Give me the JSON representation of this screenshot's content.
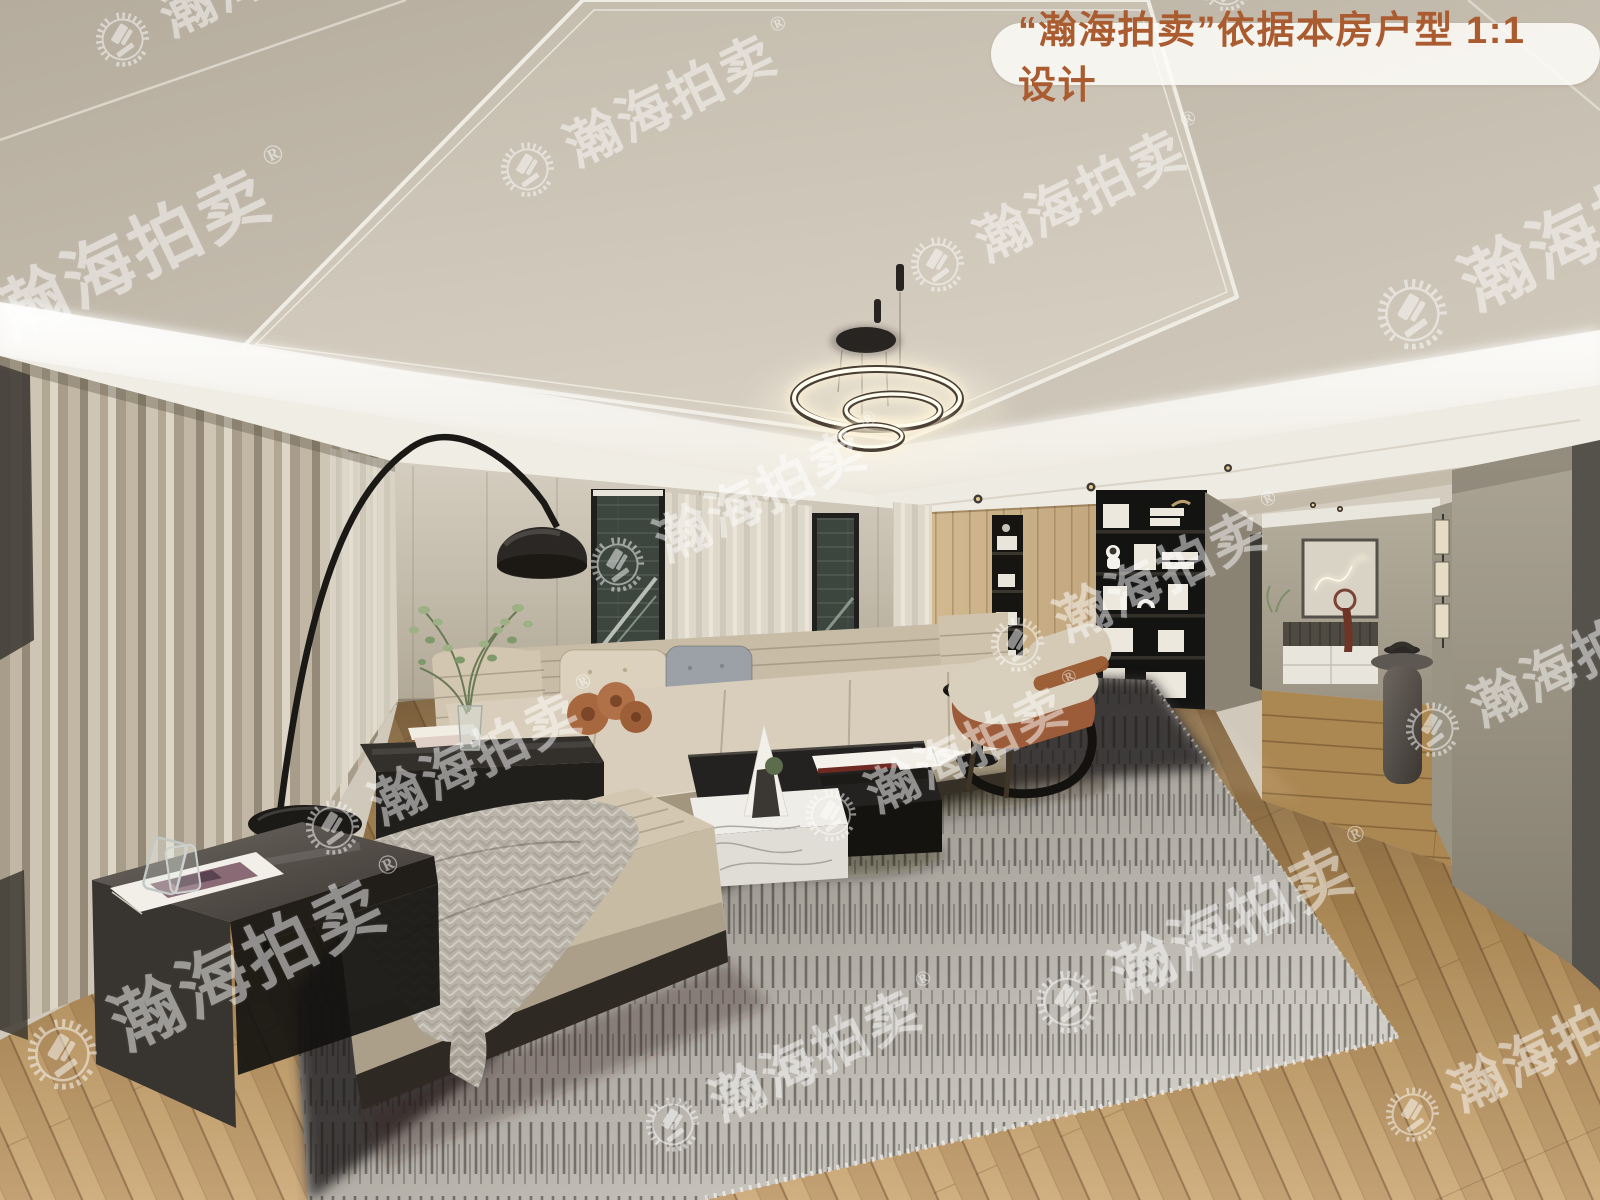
{
  "image_type": "real-estate interior render photo",
  "badge": {
    "text": "“瀚海拍卖”依据本房户型 1:1 设计",
    "text_color": "#aa5c30",
    "background_color": "#fbf9f5"
  },
  "watermark": {
    "text": "瀚海拍卖",
    "registered_mark": "®",
    "logo_icon": "auction-gavel-laurel-wreath",
    "color": "#ffffff",
    "opacity": 0.5
  },
  "scene": {
    "label": "modern beige living room with cove-lit tray ceiling, ring chandelier, long sofa, bookshelf wall and hallway",
    "palette": {
      "ceiling": "#cdc5b8",
      "cove_light": "#ffffff",
      "wall": "#bfb6a5",
      "curtain": "#b3a894",
      "wood_wall": "#c4ab83",
      "wood_floor": "#b9956a",
      "sofa": "#d6cab5",
      "rug_dark": "#33302c",
      "rug_light": "#d9d6cf",
      "accent_rust": "#9c5c39",
      "hallway_wall": "#9a9486",
      "furniture_black": "#1f1d1a"
    }
  }
}
